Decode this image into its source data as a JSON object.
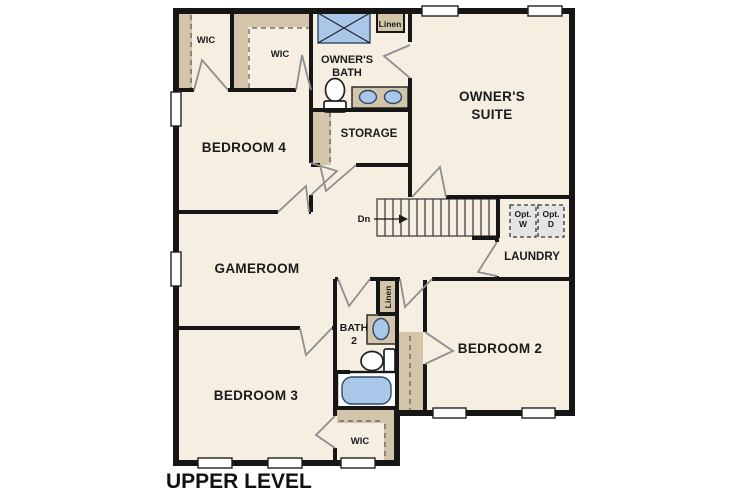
{
  "plan": {
    "title": "UPPER LEVEL",
    "colors": {
      "floor": "#f5eee1",
      "closet_tan": "#d2c5a9",
      "wall": "#161616",
      "fixture_blue": "#a9c7e8",
      "appliance_gray": "#e4e4e4",
      "door_gray": "#8e8e8e"
    },
    "rooms": {
      "wic_top_left": "WIC",
      "wic_top_mid": "WIC",
      "linen_upper": "Linen",
      "owners_bath_line1": "OWNER'S",
      "owners_bath_line2": "BATH",
      "owners_suite_line1": "OWNER'S",
      "owners_suite_line2": "SUITE",
      "bedroom4": "BEDROOM 4",
      "storage": "STORAGE",
      "gameroom": "GAMEROOM",
      "laundry": "LAUNDRY",
      "bath2_line1": "BATH",
      "bath2_line2": "2",
      "linen_bath2": "Linen",
      "bedroom2": "BEDROOM 2",
      "bedroom3": "BEDROOM 3",
      "wic_bottom": "WIC"
    },
    "annotations": {
      "stairs_down": "Dn",
      "opt_washer_line1": "Opt.",
      "opt_washer_line2": "W",
      "opt_dryer_line1": "Opt.",
      "opt_dryer_line2": "D"
    }
  }
}
